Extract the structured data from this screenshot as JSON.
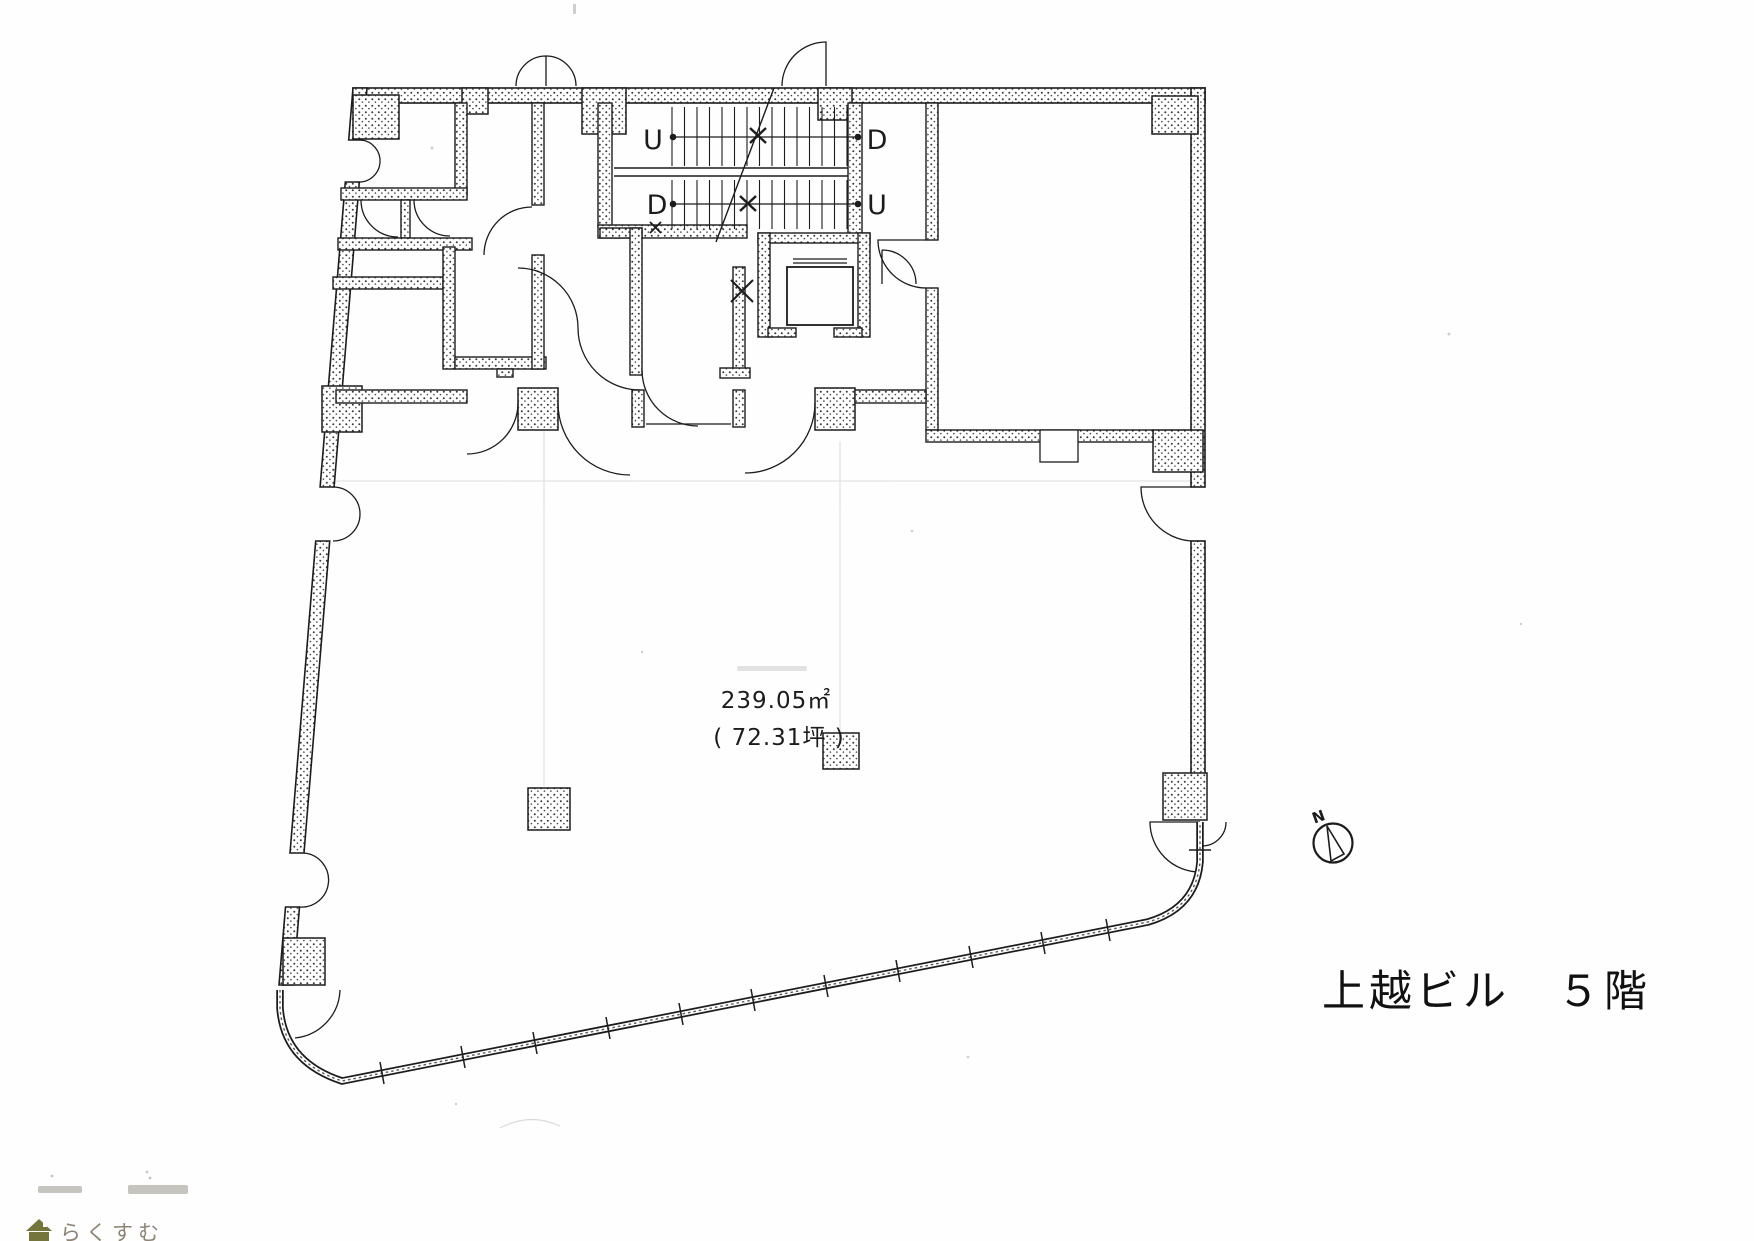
{
  "floor_plan": {
    "area": {
      "square_meters": "239.05㎡",
      "tsubo": "( 72.31坪 )"
    },
    "stair_labels": {
      "flight1_left": "U",
      "flight1_right": "D",
      "flight2_left": "D",
      "flight2_right": "U"
    },
    "compass": {
      "north": "N"
    }
  },
  "caption": {
    "building_and_floor": "上越ビル　５階"
  },
  "footer": {
    "brand": "らくすむ"
  },
  "colors": {
    "ink": "#1c1c1c",
    "logo_text": "#8d8476",
    "logo_icon": "#73753a"
  }
}
